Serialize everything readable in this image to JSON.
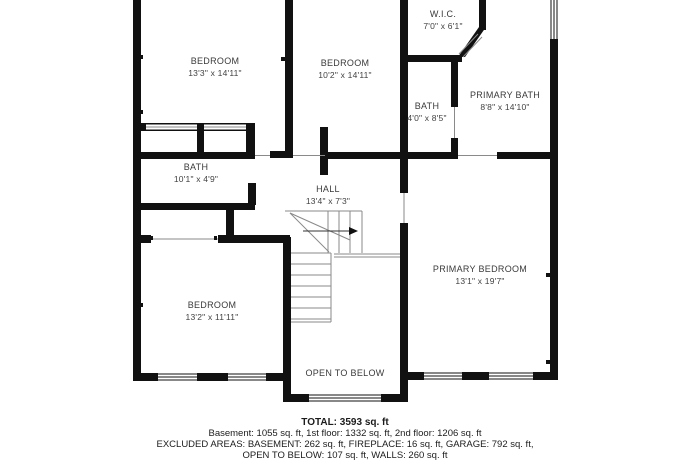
{
  "rooms": [
    {
      "id": "bedroom-1",
      "name": "BEDROOM",
      "dims": "13'3\" x 14'11\""
    },
    {
      "id": "bedroom-2",
      "name": "BEDROOM",
      "dims": "10'2\" x 14'11\""
    },
    {
      "id": "wic",
      "name": "W.I.C.",
      "dims": "7'0\" x 6'1\""
    },
    {
      "id": "bath-2",
      "name": "BATH",
      "dims": "4'0\" x 8'5\""
    },
    {
      "id": "primary-bath",
      "name": "PRIMARY BATH",
      "dims": "8'8\" x 14'10\""
    },
    {
      "id": "bath-1",
      "name": "BATH",
      "dims": "10'1\" x 4'9\""
    },
    {
      "id": "hall",
      "name": "HALL",
      "dims": "13'4\" x 7'3\""
    },
    {
      "id": "bedroom-3",
      "name": "BEDROOM",
      "dims": "13'2\" x 11'11\""
    },
    {
      "id": "primary-bedroom",
      "name": "PRIMARY BEDROOM",
      "dims": "13'1\" x 19'7\""
    },
    {
      "id": "open-to-below",
      "name": "OPEN TO BELOW",
      "dims": ""
    }
  ],
  "summary": {
    "total": "TOTAL: 3593 sq. ft",
    "floors": "Basement: 1055 sq. ft, 1st floor: 1332 sq. ft, 2nd floor: 1206 sq. ft",
    "excluded_1": "EXCLUDED AREAS: BASEMENT: 262 sq. ft, FIREPLACE: 16 sq. ft, GARAGE: 792 sq. ft,",
    "excluded_2": "OPEN TO BELOW: 107 sq. ft, WALLS: 260 sq. ft"
  },
  "colors": {
    "wall": "#111111",
    "thin_line": "#8a8a8a",
    "label_text": "#3a3a3a"
  }
}
